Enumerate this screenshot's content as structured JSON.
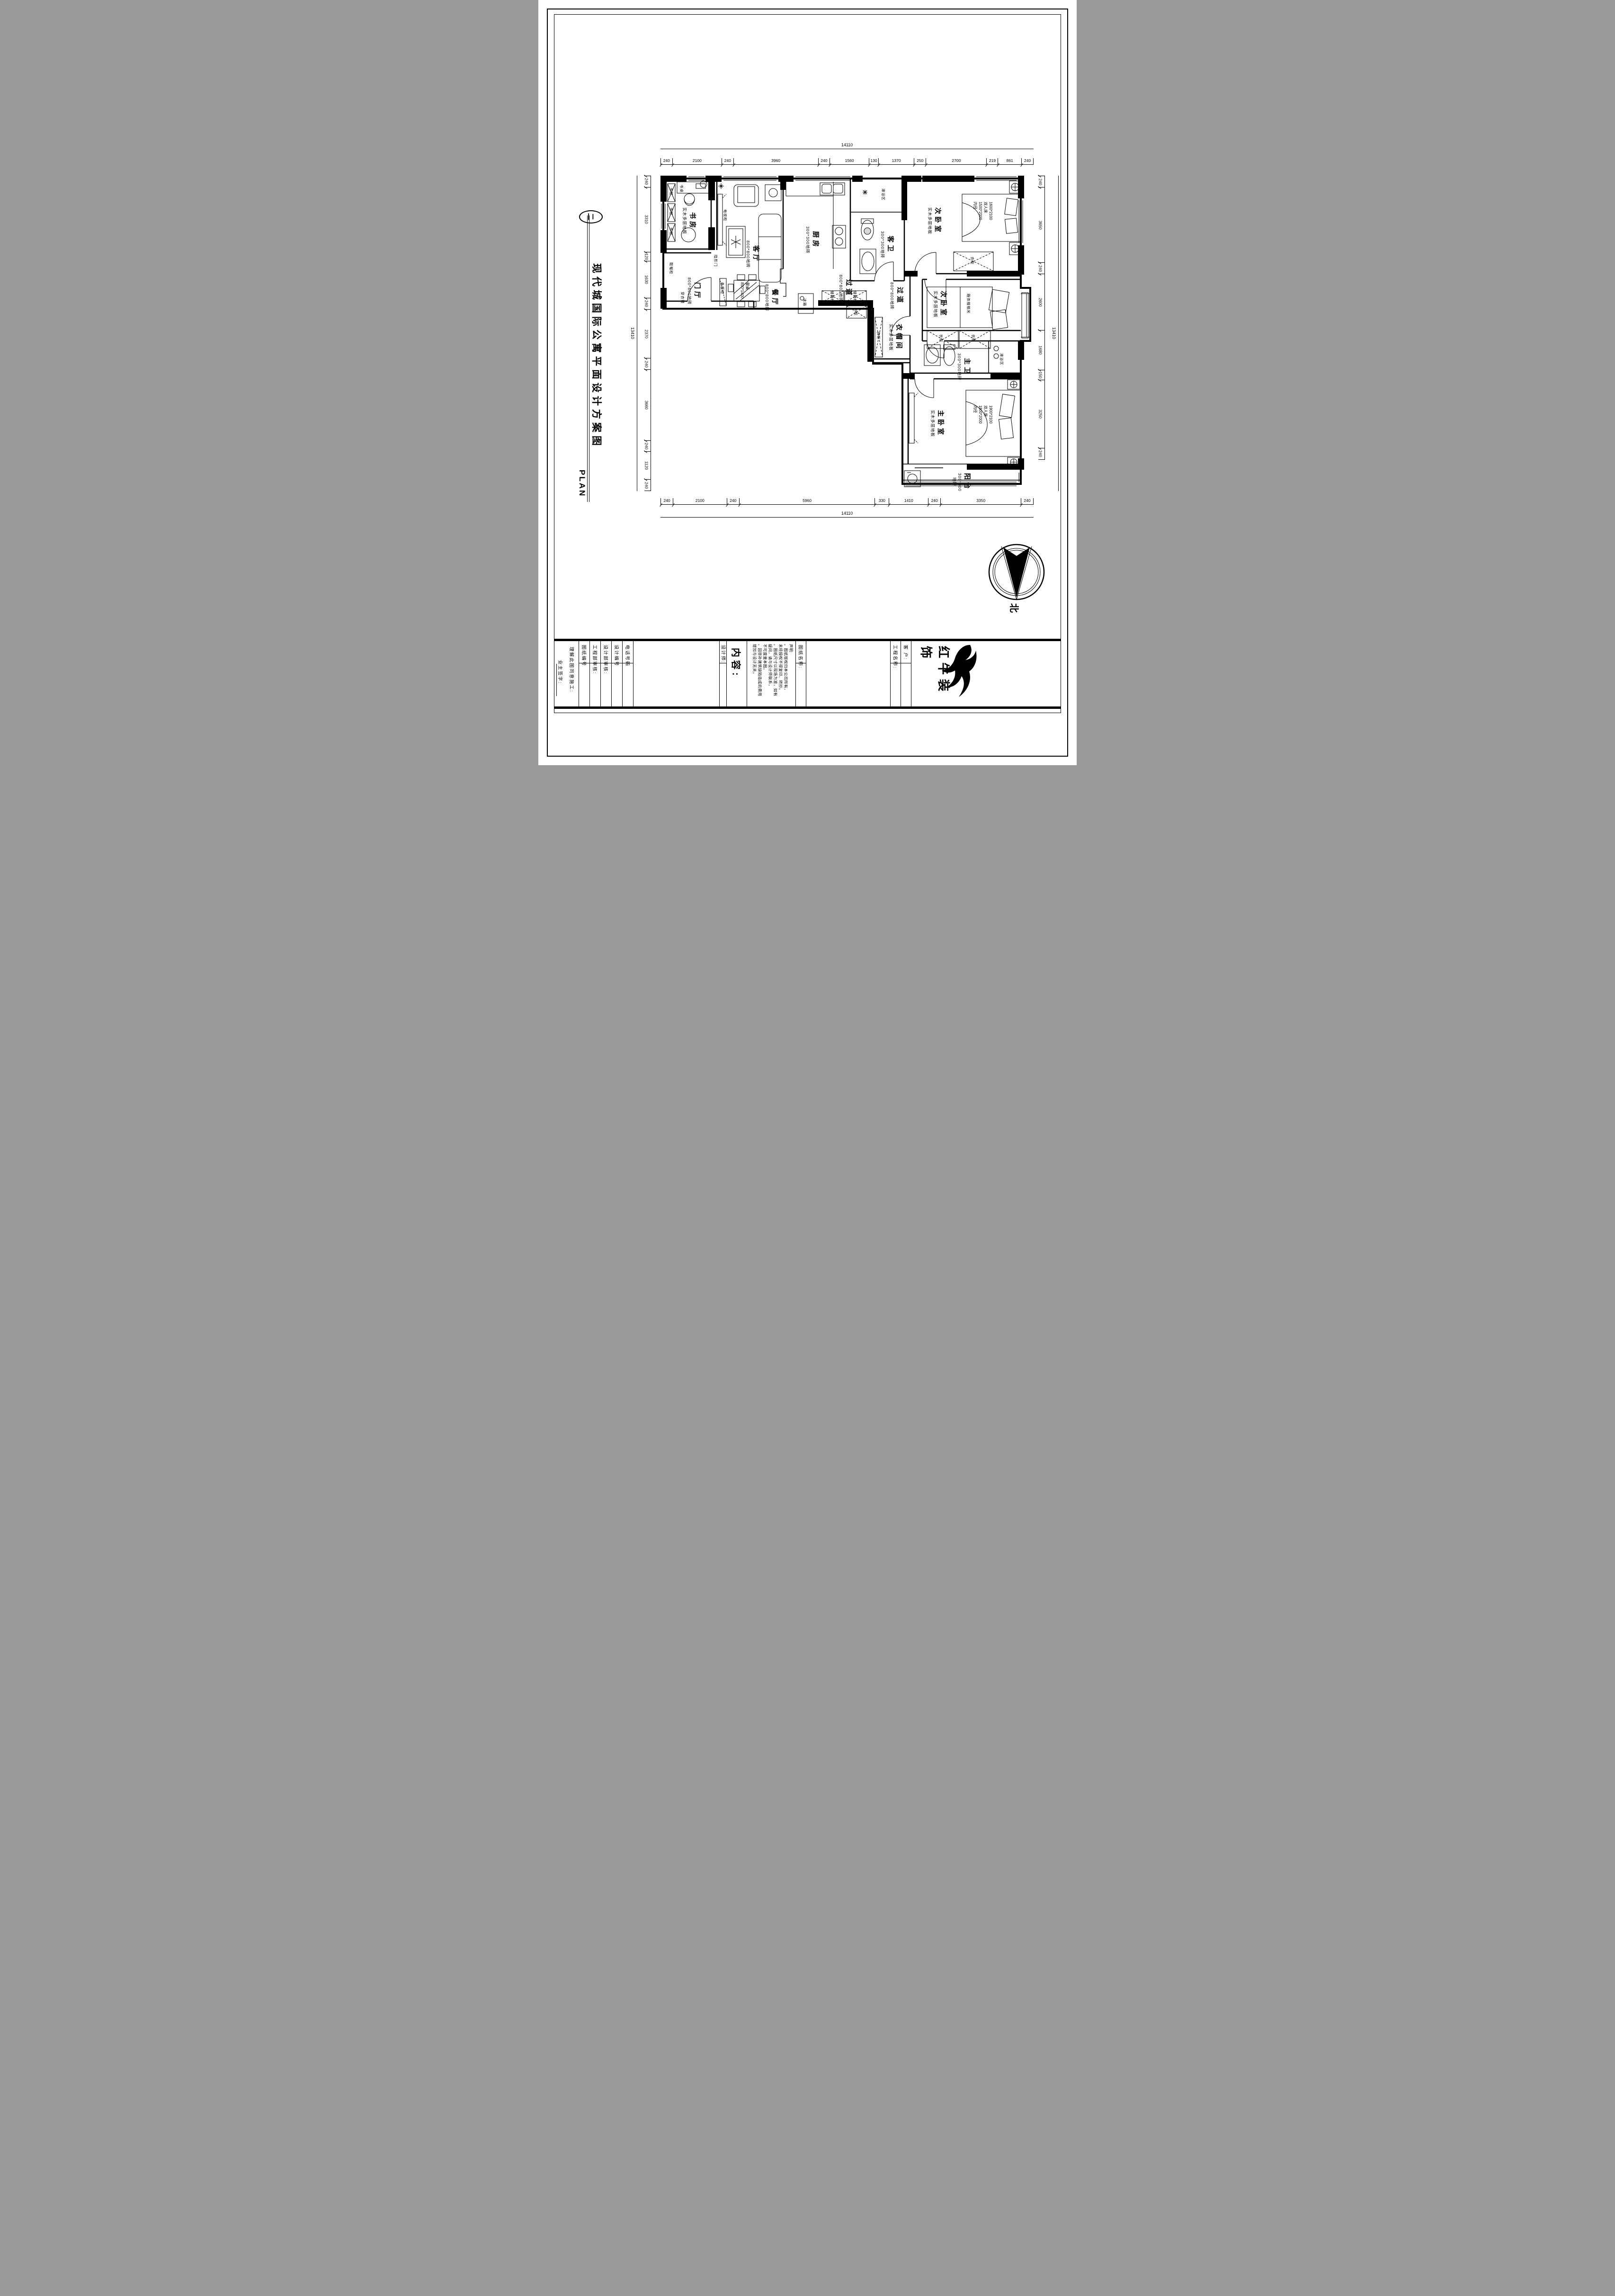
{
  "page": {
    "figure_no": "二",
    "title": "现代城国际公寓平面设计方案图",
    "plan_label": "PLAN",
    "north": "北"
  },
  "dims": {
    "top": {
      "total": "14110",
      "segments": [
        "240",
        "2100",
        "240",
        "3960",
        "240",
        "1560",
        "130",
        "1370",
        "250",
        "2700",
        "219",
        "861",
        "240"
      ]
    },
    "bottom": {
      "total": "14110",
      "segments": [
        "240",
        "2100",
        "240",
        "5960",
        "330",
        "1410",
        "240",
        "3350",
        "240"
      ]
    },
    "left": {
      "total": "13410",
      "segments": [
        "240",
        "3310",
        "120",
        "1630",
        "240",
        "2370",
        "240",
        "3660",
        "240",
        "1120",
        "240"
      ]
    },
    "right": {
      "total": "13410",
      "segments": [
        "240",
        "3650",
        "240",
        "2600",
        "1680",
        "150",
        "3250",
        "240"
      ]
    }
  },
  "rooms": {
    "study": {
      "name": "书房",
      "spec": "实木多层地板"
    },
    "living": {
      "name": "客厅",
      "spec": "800*800地砖"
    },
    "dining": {
      "name": "餐厅",
      "spec": "800*800地砖"
    },
    "entry": {
      "name": "门厅",
      "spec": "800*800地砖"
    },
    "kitchen": {
      "name": "厨房",
      "spec": "300*300地砖"
    },
    "guest_bath": {
      "name": "客卫",
      "spec": "300*300地砖"
    },
    "shower": {
      "name": "淋浴区"
    },
    "bedroom_top": {
      "name": "次卧室",
      "spec": "实木多层地板"
    },
    "corridor": {
      "name": "过道",
      "spec": "800*800地砖"
    },
    "closet": {
      "name": "衣帽间",
      "spec": "实木多层地板"
    },
    "bedroom_mid": {
      "name": "次卧室",
      "spec": "实木多层地板"
    },
    "master_bath": {
      "name": "主卫",
      "spec": "300*300地砖"
    },
    "master_bedroom": {
      "name": "主卧室",
      "spec": "实木多层地板"
    },
    "balcony": {
      "name": "阳台",
      "spec": "300*300地砖"
    }
  },
  "furniture": {
    "bookcase": "书柜",
    "desk": "书桌",
    "tv_cabinet": "电视柜",
    "hidden_door": "隐形门",
    "shoe_cabinet": "鞋帽柜",
    "mirror": "穿衣镜",
    "serving_cabinet": "备餐柜",
    "dining_table": "餐桌\n800*1400",
    "fridge": "冰箱",
    "storage_cabinet": "储物柜",
    "wardrobe": "衣柜",
    "tatami": "箱体榻榻米",
    "bed_top": "1600*2100\n双人床\n1500*2000\n内径",
    "bed_master": "1900*2100\n双人床\n1800*2000\n内径"
  },
  "titleblock": {
    "owner_sign": "业主签字:",
    "agree": "理解此图同意施工:",
    "drawing_no": "图纸编号",
    "eng_review": "工程部审核:",
    "design_review": "设计部审核:",
    "design_no": "设计编号",
    "phone": "电话号码",
    "designer": "设计师:",
    "content": "内容:",
    "declaration": "声明:\n。图纸版权归本公司所有，\n未经授权不得复印、转抄。\n。图纸尺寸以现场为准，如有\n疑问，请与设计师联系，\n不可度量本图。\n。因弥补建筑缺陷造成的费用\n增加与设计无关。",
    "drawing_name": "图纸名称:",
    "project_name": "工程名称:",
    "client": "客 户:",
    "brand": "红牛装饰"
  }
}
